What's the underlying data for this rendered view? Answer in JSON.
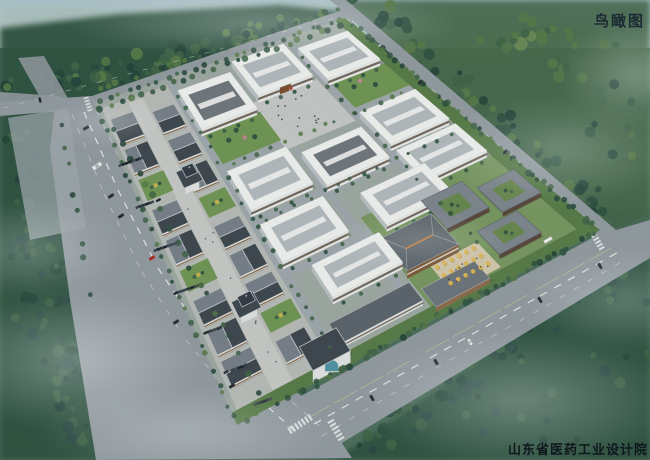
{
  "labels": {
    "view_title": "鸟瞰图",
    "institute_caption": "山东省医药工业设计院"
  },
  "scene": {
    "description": "Bird's-eye architectural rendering of a pharmaceutical industrial park",
    "factory_buildings": 10,
    "commercial_shop_buildings": 14,
    "towers": 2,
    "courtyard_buildings": 3,
    "admin_building": 1,
    "entrance_plaza": 1,
    "ginkgo_plaza": 1,
    "parking_rows": 7
  },
  "palette": {
    "sky_top": "#a9bfc8",
    "sky_bottom": "#c8d4d2",
    "ground": "#4d6d5b",
    "field_haze": "#9eb4a6",
    "field_pale": "#93a96d",
    "tree_deep": "#24443a",
    "tree_dark": "#2f5140",
    "tree_mid": "#3f6247",
    "tree_light": "#557748",
    "tree_pale": "#6d8a56",
    "tree_blue": "#2c4a44",
    "mist": "#eef5f4",
    "road": "#8e979c",
    "road_light": "#9aa3a7",
    "lane": "#e9edec",
    "lane_yellow": "#cfc98f",
    "campus_ground": "#9aa49e",
    "paving": "#b2b6b2",
    "paving_light": "#c0c3c0",
    "plaza": "#bfc2c0",
    "plaza_warm": "#cdc3a9",
    "factory_roof": "#e8eae8",
    "factory_roof_inner": "#aeb5b8",
    "factory_roof_dark": "#6d757b",
    "factory_wall": "#e0e3e1",
    "factory_side": "#b4bbbe",
    "window_band": "#54483c",
    "door_brown": "#7a4f30",
    "shop_roof_dark": "#3e474e",
    "shop_roof_lit": "#747d85",
    "ridge": "#bac1c5",
    "shop_wall": "#d9dcda",
    "wood": "#77573a",
    "courtyard_roof": "#7b838a",
    "courtyard_green": "#66854e",
    "admin_roof": "#5d656c",
    "admin_wood": "#7a5a3a",
    "gold": "#d8b455",
    "gold_deep": "#a8852f",
    "garden": "#6e9154",
    "hedge": "#3f6140",
    "teal_glass": "#4e8fa0",
    "pink_tree": "#c08394",
    "car_dark": "#2b343b",
    "car_red": "#b03328",
    "car_white": "#dfe3e2",
    "shadow": "#000000",
    "text_dark": "#1c2a33"
  }
}
